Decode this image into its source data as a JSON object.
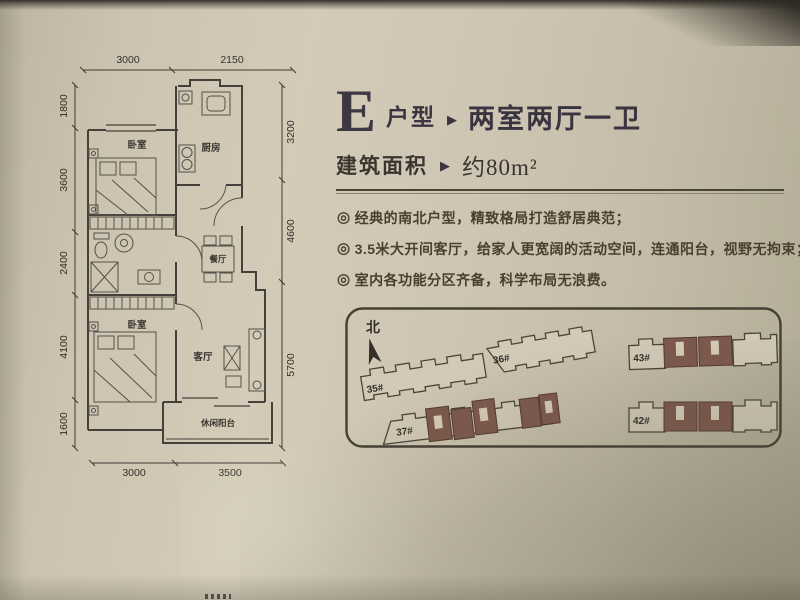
{
  "header": {
    "type_letter": "E",
    "type_label": "户型",
    "separator": "▶",
    "layout": "两室两厅一卫",
    "area_label": "建筑面积",
    "area_separator": "▶",
    "area_value": "约80m²"
  },
  "features": {
    "marker": "◎",
    "items": [
      "经典的南北户型，精致格局打造舒居典范；",
      "3.5米大开间客厅，给家人更宽阔的活动空间，连通阳台，视野无拘束；",
      "室内各功能分区齐备，科学布局无浪费。"
    ]
  },
  "floorplan": {
    "rooms": {
      "bedroom_top": "卧室",
      "kitchen": "厨房",
      "dining": "餐厅",
      "bedroom_bottom": "卧室",
      "living": "客厅",
      "balcony": "休闲阳台"
    },
    "dims": {
      "top": [
        "3000",
        "2150"
      ],
      "left": [
        "1800",
        "3600",
        "2400",
        "4100",
        "1600"
      ],
      "right": [
        "3200",
        "4600",
        "5700"
      ],
      "bottom": [
        "3000",
        "3500"
      ]
    }
  },
  "siteplan": {
    "north": "北",
    "buildings": [
      {
        "id": "35#",
        "highlighted": false
      },
      {
        "id": "36#",
        "highlighted": false
      },
      {
        "id": "37#",
        "highlighted": true
      },
      {
        "id": "43#",
        "highlighted": true
      },
      {
        "id": "42#",
        "highlighted": true
      }
    ]
  },
  "colors": {
    "paper": "#cdc5b1",
    "ink": "#46403a",
    "title": "#3c3742",
    "highlight_unit": "#7d584c"
  }
}
